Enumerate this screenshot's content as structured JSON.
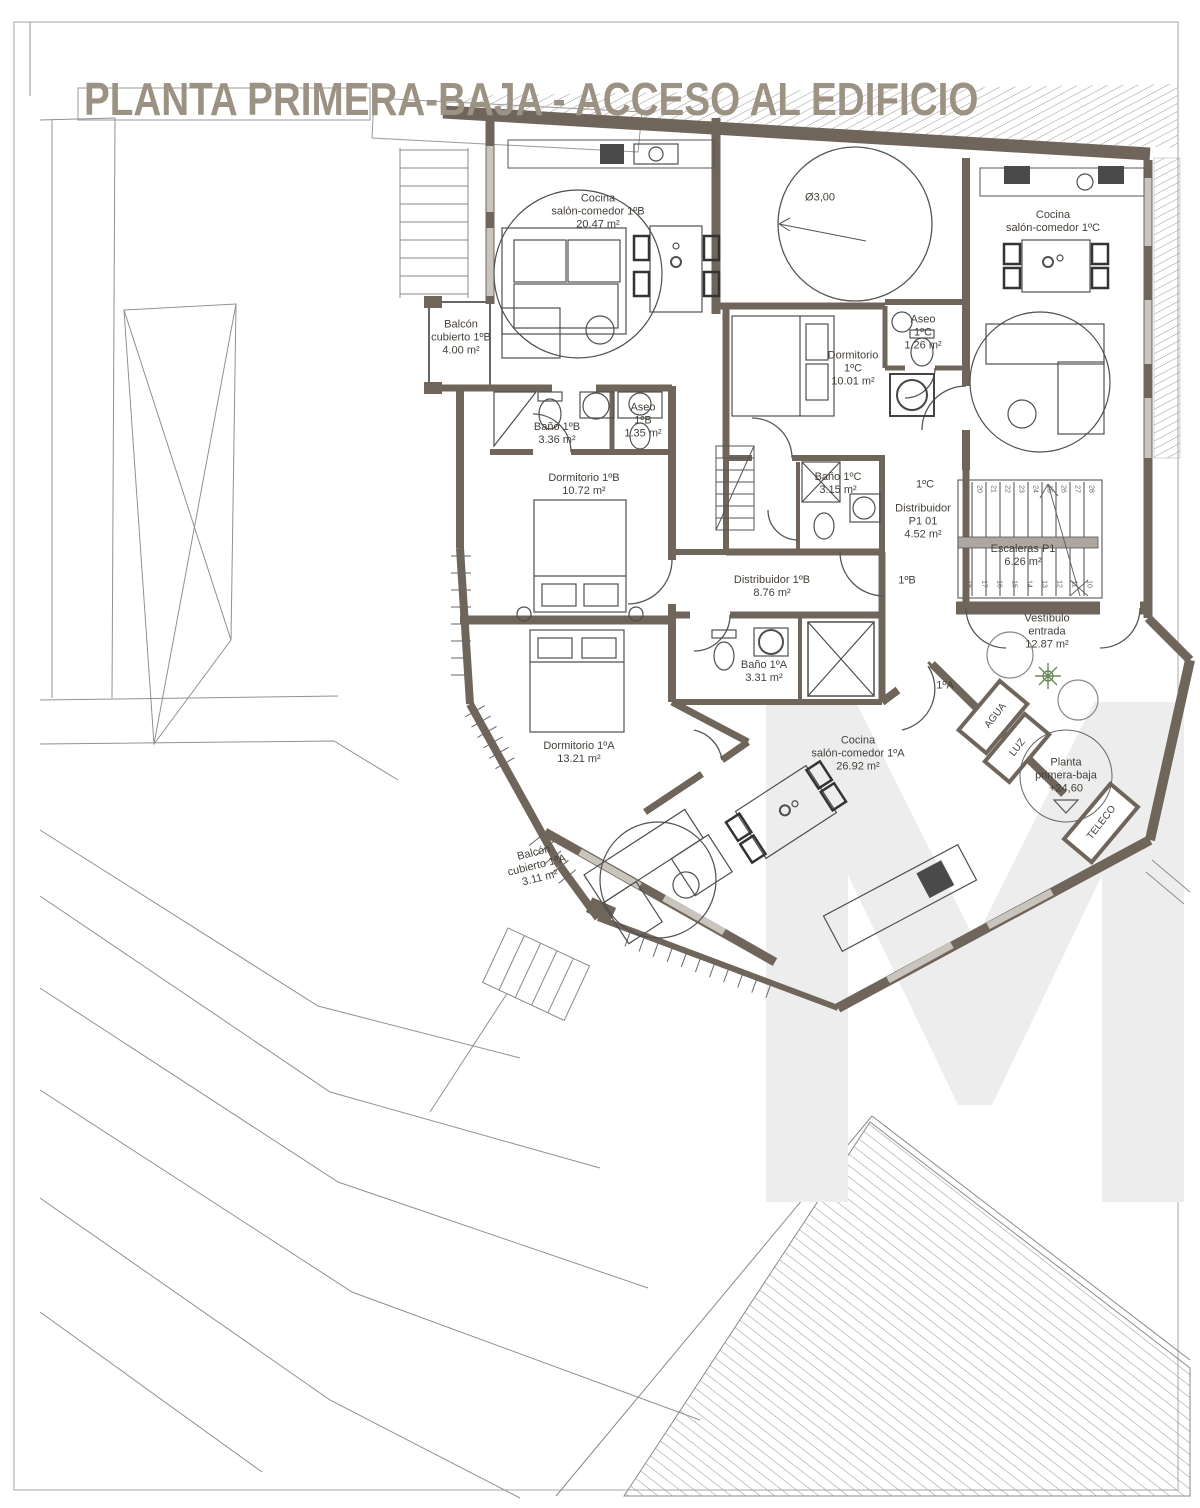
{
  "title": "PLANTA PRIMERA-BAJA - ACCESO AL EDIFICIO",
  "watermark_letter": "M",
  "colors": {
    "wall": "#6F655A",
    "thin_line": "#555555",
    "site_line": "#909090",
    "window": "#C9C4BD",
    "title": "#9B9283",
    "label": "#45403A",
    "watermark": "#EDEDED"
  },
  "labels": [
    {
      "id": "cocina-1b",
      "x": 598,
      "y": 212,
      "text": "Cocina\nsalón-comedor 1ºB\n20.47 m²"
    },
    {
      "id": "patio-diameter",
      "x": 820,
      "y": 198,
      "text": "Ø3,00"
    },
    {
      "id": "cocina-1c",
      "x": 1053,
      "y": 222,
      "text": "Cocina\nsalón-comedor 1ºC"
    },
    {
      "id": "balcon-1b",
      "x": 461,
      "y": 338,
      "text": "Balcón\ncubierto 1ºB\n4.00 m²"
    },
    {
      "id": "aseo-1c",
      "x": 923,
      "y": 333,
      "text": "Aseo\n1ºC\n1.26 m²"
    },
    {
      "id": "dormitorio-1c",
      "x": 853,
      "y": 369,
      "text": "Dormitorio\n1ºC\n10.01 m²"
    },
    {
      "id": "bano-1b",
      "x": 557,
      "y": 434,
      "text": "Baño 1ºB\n3.36 m²"
    },
    {
      "id": "aseo-1b",
      "x": 643,
      "y": 421,
      "text": "Aseo\n1ºB\n1.35 m²"
    },
    {
      "id": "dormitorio-1b",
      "x": 584,
      "y": 485,
      "text": "Dormitorio 1ºB\n10.72 m²"
    },
    {
      "id": "bano-1c",
      "x": 838,
      "y": 484,
      "text": "Baño 1ºC\n3.15 m²"
    },
    {
      "id": "puerta-1c",
      "x": 925,
      "y": 485,
      "text": "1ºC"
    },
    {
      "id": "distribuidor-p1",
      "x": 923,
      "y": 522,
      "text": "Distribuidor\nP1 01\n4.52 m²"
    },
    {
      "id": "escaleras-p1",
      "x": 1023,
      "y": 556,
      "text": "Escaleras P1\n6.26 m²"
    },
    {
      "id": "distribuidor-1b",
      "x": 772,
      "y": 587,
      "text": "Distribuidor 1ºB\n8.76 m²"
    },
    {
      "id": "puerta-1b",
      "x": 907,
      "y": 581,
      "text": "1ºB"
    },
    {
      "id": "vestibulo",
      "x": 1047,
      "y": 632,
      "text": "Vestíbulo\nentrada\n12.87 m²"
    },
    {
      "id": "bano-1a",
      "x": 764,
      "y": 672,
      "text": "Baño 1ºA\n3.31 m²"
    },
    {
      "id": "puerta-1a",
      "x": 945,
      "y": 686,
      "text": "1ºA"
    },
    {
      "id": "agua",
      "x": 996,
      "y": 716,
      "rotate": -52,
      "size": 10,
      "text": "AGUA"
    },
    {
      "id": "luz",
      "x": 1018,
      "y": 748,
      "rotate": -52,
      "size": 10,
      "text": "LUZ"
    },
    {
      "id": "dormitorio-1a",
      "x": 579,
      "y": 753,
      "text": "Dormitorio 1ºA\n13.21 m²"
    },
    {
      "id": "cocina-1a",
      "x": 858,
      "y": 754,
      "text": "Cocina\nsalón-comedor 1ºA\n26.92 m²"
    },
    {
      "id": "nivel-planta",
      "x": 1066,
      "y": 776,
      "text": "Planta\nprimera-baja\n+24,60"
    },
    {
      "id": "teleco",
      "x": 1102,
      "y": 823,
      "rotate": -52,
      "size": 10,
      "text": "TELECO"
    },
    {
      "id": "balcon-1a",
      "x": 537,
      "y": 866,
      "rotate": -14,
      "text": "Balcón\ncubierto 1ºA\n3.11 m²"
    }
  ],
  "stairs": {
    "top_numbers": [
      "19",
      "20",
      "21",
      "22",
      "23",
      "24",
      "25",
      "26",
      "27",
      "28"
    ],
    "bottom_numbers": [
      "18",
      "17",
      "16",
      "15",
      "14",
      "13",
      "12",
      "11",
      "10"
    ]
  }
}
